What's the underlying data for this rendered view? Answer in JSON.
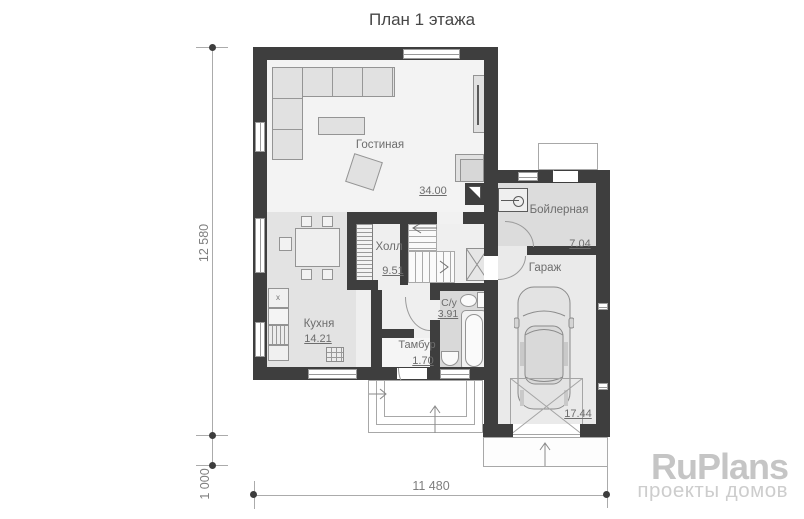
{
  "title": "План 1 этажа",
  "rooms": {
    "living": {
      "name": "Гостиная",
      "area": "34.00"
    },
    "hall": {
      "name": "Холл",
      "area": "9.51"
    },
    "kitchen": {
      "name": "Кухня",
      "area": "14.21"
    },
    "vestibule": {
      "name": "Тамбур",
      "area": "1.70"
    },
    "bathroom": {
      "name": "С/у",
      "area": "3.91"
    },
    "boiler": {
      "name": "Бойлерная",
      "area": "7.04"
    },
    "garage": {
      "name": "Гараж",
      "area": "17.44"
    }
  },
  "dimensions": {
    "total_height": "12 580",
    "porch_depth": "1 000",
    "total_width": "11 480"
  },
  "symbols": {
    "fridge_mark": "x"
  },
  "watermark": {
    "brand": "RuPlans",
    "tagline": "проекты домов"
  },
  "colors": {
    "wall": "#3e3e3e",
    "room_light": "#f3f3f3",
    "room_gray": "#e3e3e3",
    "watermark_gray": "#c5c5c5"
  }
}
